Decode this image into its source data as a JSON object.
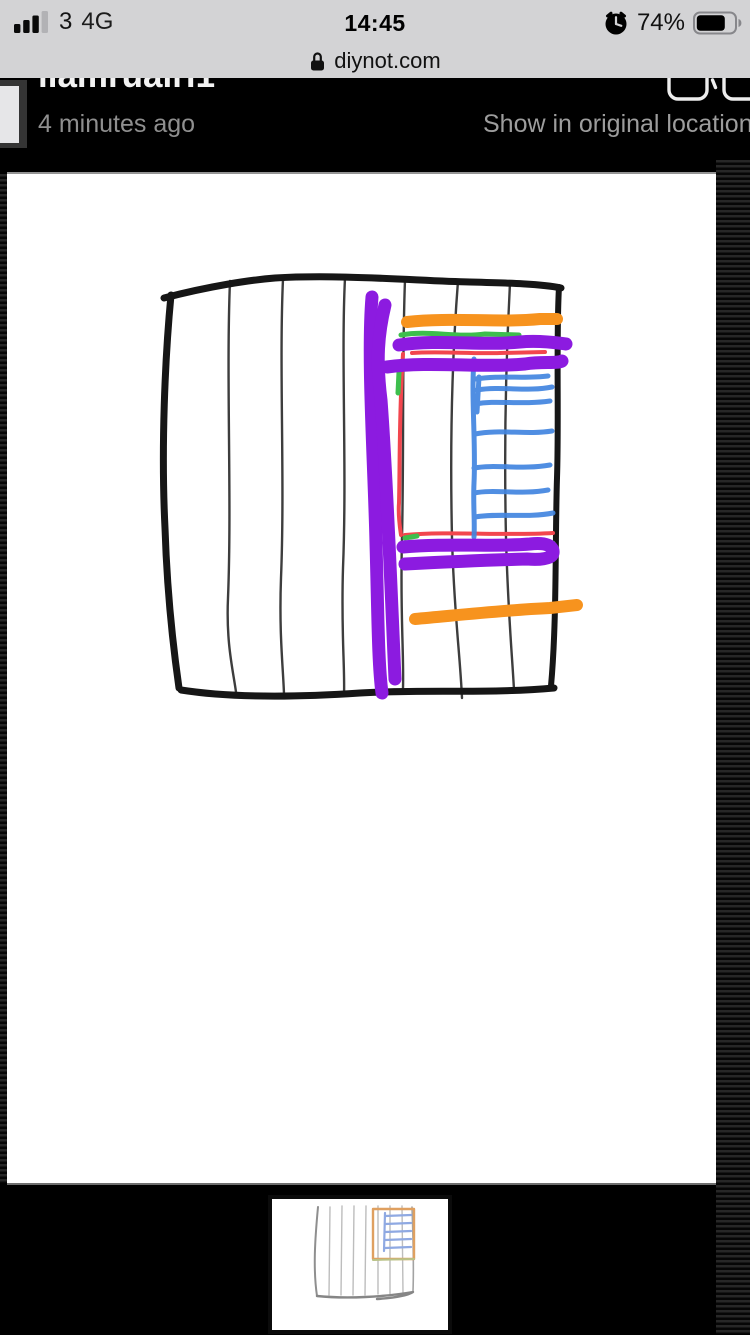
{
  "status_bar": {
    "carrier": "3",
    "network": "4G",
    "time": "14:45",
    "battery_percent": "74%"
  },
  "url_bar": {
    "domain": "diynot.com"
  },
  "viewer_header": {
    "username": "liamruairi1",
    "posted": "4 minutes ago",
    "link": "Show in original location"
  },
  "drawing": {
    "alt": "Hand-drawn sketch of a fence panel with vertical boards, annotated with thick purple, orange, red, green and blue marker strokes",
    "colors": {
      "purple": "#8C1BE0",
      "orange": "#F7931E",
      "blue": "#4285E0",
      "red": "#F2464E",
      "green": "#3DBE4D",
      "sketch": "#161616",
      "sketch_light": "#3d3d3d"
    }
  }
}
